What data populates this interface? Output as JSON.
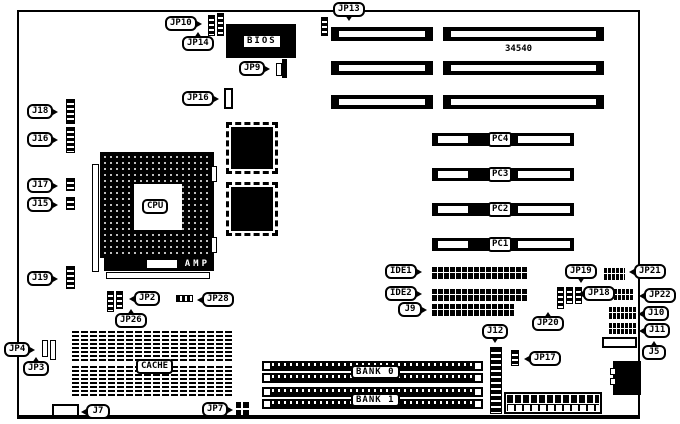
{
  "diagram": {
    "type": "motherboard-layout",
    "part_number": "34540",
    "colors": {
      "board_bg": "#ffffff",
      "component": "#000000",
      "label_bg": "#ffffff"
    }
  },
  "chips": {
    "bios": "BIOS",
    "cpu": "CPU",
    "amp": "AMP",
    "cache": "CACHE"
  },
  "pci_slots": {
    "pc4": "PC4",
    "pc3": "PC3",
    "pc2": "PC2",
    "pc1": "PC1"
  },
  "memory_banks": {
    "bank0": "BANK 0",
    "bank1": "BANK 1"
  },
  "callouts": {
    "jp10": "JP10",
    "jp14": "JP14",
    "jp9": "JP9",
    "jp16": "JP16",
    "jp13": "JP13",
    "j18": "J18",
    "j16": "J16",
    "j17": "J17",
    "j15": "J15",
    "j19": "J19",
    "jp2": "JP2",
    "jp26": "JP26",
    "jp28": "JP28",
    "jp4": "JP4",
    "jp3": "JP3",
    "j7": "J7",
    "jp7": "JP7",
    "ide1": "IDE1",
    "ide2": "IDE2",
    "j9": "J9",
    "j12": "J12",
    "jp17": "JP17",
    "jp19": "JP19",
    "jp18": "JP18",
    "jp20": "JP20",
    "jp21": "JP21",
    "jp22": "JP22",
    "j10": "J10",
    "j11": "J11",
    "j5": "J5"
  }
}
